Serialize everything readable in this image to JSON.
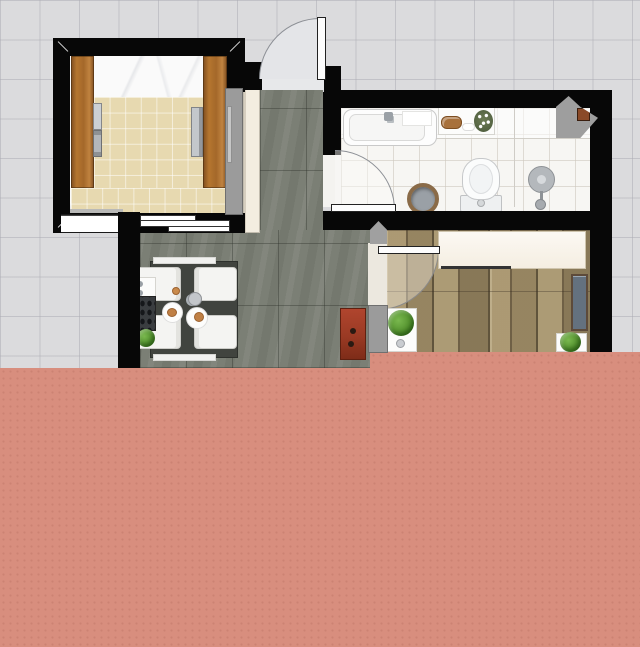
{
  "view": {
    "type": "2d-floor-plan",
    "grid_visible": true,
    "text_labels": "none"
  },
  "colors": {
    "background": "#dbdbdd",
    "wall": "#070707",
    "wall_cut": "#9b9b9b",
    "terrace_floor": "#d88e7e",
    "hall_dining_floor": "#7b7f75",
    "kitchen_tile": "#ecdfb8",
    "kitchen_counter": "#fafafa",
    "bathroom_floor": "#f7f6f3",
    "bedroom_wood_floor": "#96855f",
    "kitchen_cabinet_wood": "#a4682a",
    "cream_cabinet": "#f3ede0",
    "wardrobe": "#f8f2e7",
    "red_cabinet": "#a23c27",
    "blue_unit": "#64717f",
    "plant_green": "#5a9638",
    "appliance_gray": "#c6cace",
    "table": "#41443f",
    "chair": "#f4f4f2",
    "pipe_box": "#8a4a28"
  },
  "rooms": [
    {
      "id": "kitchen",
      "floor": "beige-tile"
    },
    {
      "id": "bathroom",
      "floor": "white-tile"
    },
    {
      "id": "hallway",
      "floor": "dark-gray-tile"
    },
    {
      "id": "dining-area",
      "floor": "dark-gray-tile"
    },
    {
      "id": "bedroom",
      "floor": "wood-plank"
    },
    {
      "id": "terrace",
      "floor": "salmon"
    }
  ],
  "furniture": [
    "kitchen-cabinet-left",
    "kitchen-cabinet-right",
    "kitchen-sink",
    "kitchen-stove",
    "kitchen-oven",
    "kitchen-window",
    "entry-door",
    "bathroom-door",
    "bedroom-door",
    "bathtub",
    "bathroom-shelf",
    "wooden-tray",
    "soap-dish",
    "flower-pot",
    "toilet",
    "shower-set",
    "laundry-basket",
    "duct-column",
    "dining-table",
    "chair-top-left",
    "chair-bottom-left",
    "chair-top-right",
    "chair-bottom-right",
    "teapot",
    "plate",
    "plate",
    "side-shelf",
    "wine-rack",
    "plant-pot",
    "red-shoe-cabinet",
    "wardrobe",
    "clothes-rail",
    "blue-shelf-unit",
    "door-mat-plant-left",
    "door-mat-plant-right",
    "cream-tall-cabinet"
  ]
}
